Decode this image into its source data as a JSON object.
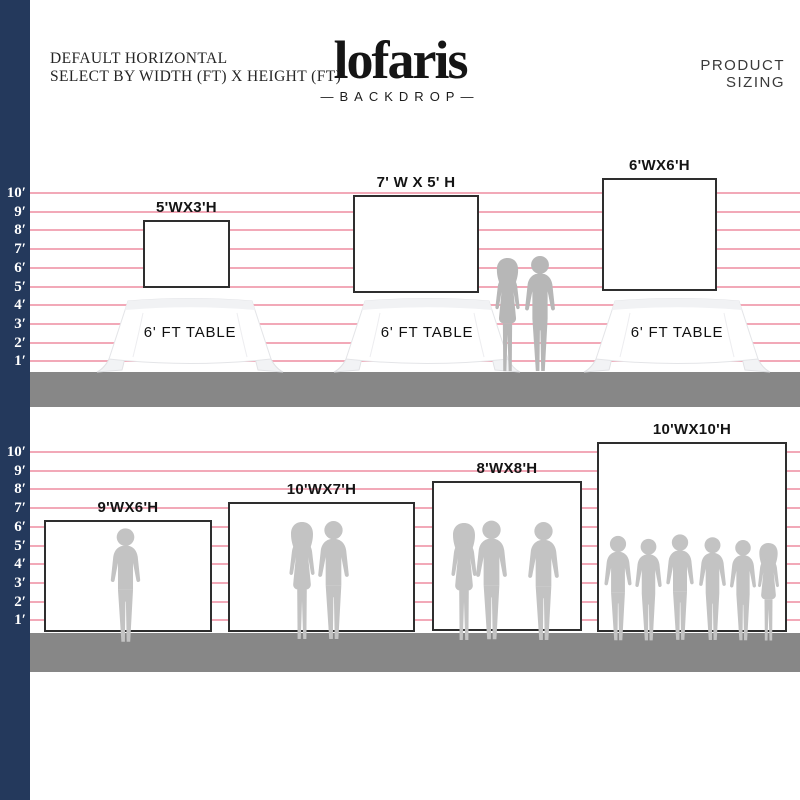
{
  "header": {
    "tagline_line1": "DEFAULT HORIZONTAL",
    "tagline_line2": "SELECT BY WIDTH (FT) X HEIGHT (FT)",
    "brand_name": "lofaris",
    "brand_subtitle": "—BACKDROP—",
    "page_title": "PRODUCT SIZING"
  },
  "ruler_feet": [
    "10′",
    "9′",
    "8′",
    "7′",
    "6′",
    "5′",
    "4′",
    "3′",
    "2′",
    "1′"
  ],
  "tabletop_section": {
    "backdrops": [
      {
        "size_label": "5'WX3'H"
      },
      {
        "size_label": "7' W X 5' H"
      },
      {
        "size_label": "6'WX6'H"
      }
    ],
    "table_label": "6' FT TABLE"
  },
  "floor_section": {
    "backdrops": [
      {
        "size_label": "9'WX6'H"
      },
      {
        "size_label": "10'WX7'H"
      },
      {
        "size_label": "8'WX8'H"
      },
      {
        "size_label": "10'WX10'H"
      }
    ]
  },
  "colors": {
    "ruler_bar_navy": "#24395c",
    "scale_line_pink": "#f2a9b8",
    "floor_gray": "#878787",
    "silhouette_gray": "#c3c3c3",
    "backdrop_border": "#2e2e2e"
  }
}
